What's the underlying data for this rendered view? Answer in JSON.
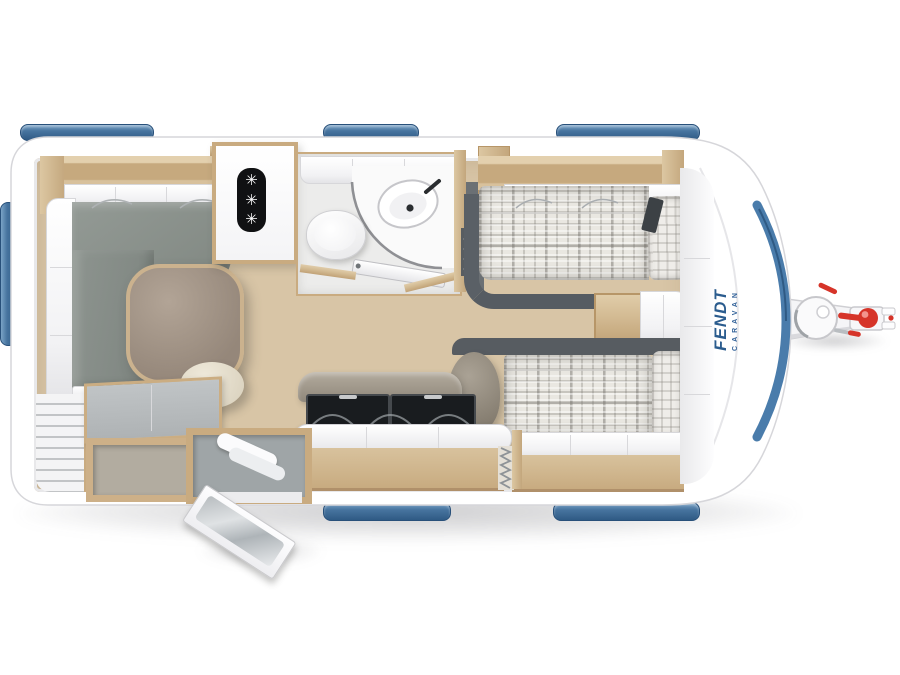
{
  "branding": {
    "logo_primary": "FENDT",
    "logo_secondary": "CARAVAN",
    "logo_color": "#2b5c8e"
  },
  "fridge": {
    "glyphs": [
      "✳",
      "✳",
      "✳"
    ],
    "badge_color": "#101113"
  },
  "colors": {
    "body_white": "#ffffff",
    "accent_stripe_blue": "#4a7cab",
    "window_blue": "#3f6e9d",
    "wood": "#d3bb93",
    "floor_wood": "#d8c5a6",
    "lounge_cushion_grey": "#8a918c",
    "bed_frame_grey": "#565c62",
    "upholstery_taupe": "#a29a8d",
    "hitch_red": "#d63429",
    "plaid_base": "#e9e7e1"
  }
}
